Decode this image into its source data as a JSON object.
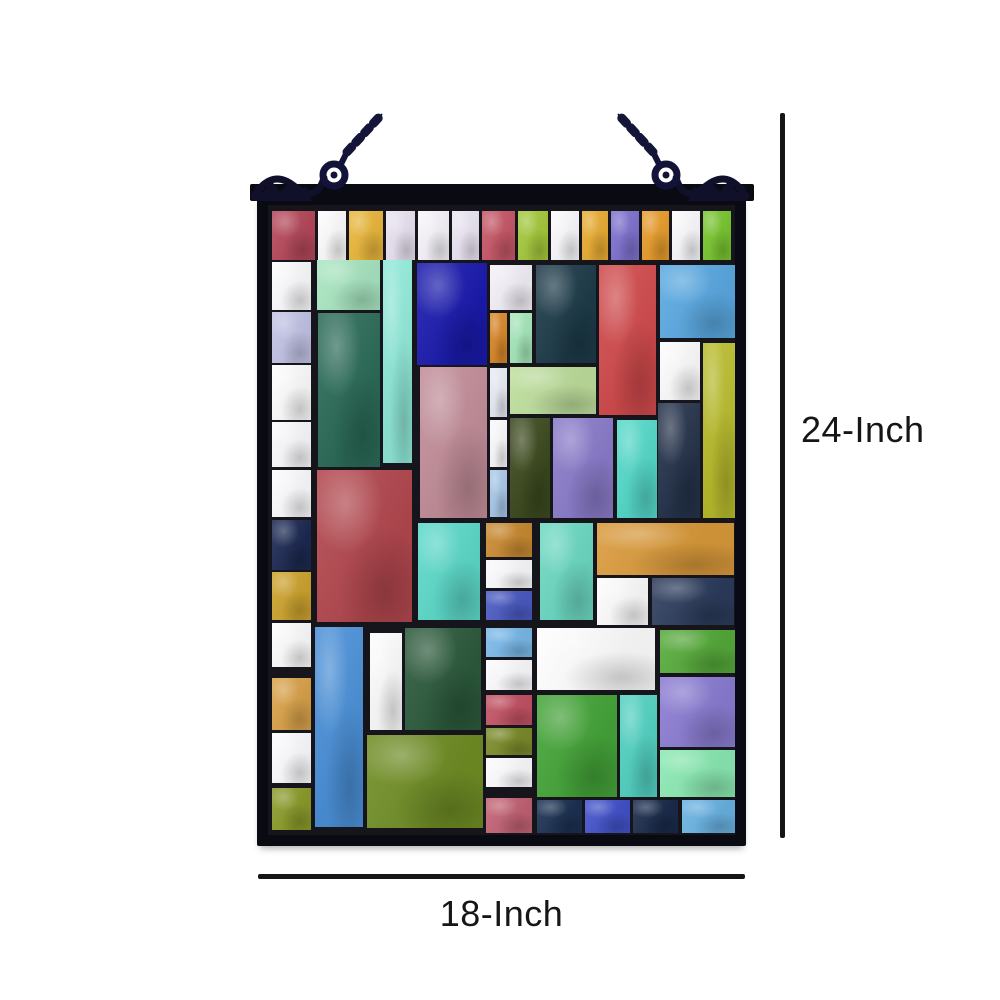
{
  "figure": {
    "subject": "Multicolor rectangle-mosaic stained glass hanging window panel with dimension callouts",
    "height_label": "24-Inch",
    "width_label": "18-Inch"
  },
  "colors": {
    "background": "#ffffff",
    "frame": "#0a0a12",
    "grout": "#15151b",
    "hardware": "#13133a",
    "dimension_line": "#151515",
    "label_text": "#161616"
  },
  "panel": {
    "glass_width": 467,
    "glass_height": 630,
    "tiles": [
      [
        4,
        6,
        43,
        49,
        "#b5485a"
      ],
      [
        50,
        6,
        28,
        49,
        "#fdfdfe"
      ],
      [
        81,
        6,
        34,
        49,
        "#eab73c"
      ],
      [
        118,
        6,
        29,
        49,
        "#e9e2f2"
      ],
      [
        150,
        6,
        31,
        49,
        "#f7f5fb"
      ],
      [
        184,
        6,
        27,
        49,
        "#ece6f4"
      ],
      [
        214,
        6,
        33,
        49,
        "#c75767"
      ],
      [
        250,
        6,
        30,
        49,
        "#a5c93c"
      ],
      [
        283,
        6,
        28,
        49,
        "#fbfafd"
      ],
      [
        314,
        6,
        26,
        49,
        "#e9ad33"
      ],
      [
        343,
        6,
        28,
        49,
        "#7e72cf"
      ],
      [
        374,
        6,
        27,
        49,
        "#e89d2c"
      ],
      [
        404,
        6,
        28,
        49,
        "#fbfbfd"
      ],
      [
        435,
        6,
        28,
        49,
        "#79c630"
      ],
      [
        4,
        57,
        39,
        48,
        "#fcfcfe"
      ],
      [
        4,
        107,
        39,
        51,
        "#c2c3e6"
      ],
      [
        4,
        160,
        39,
        55,
        "#fdfdfe"
      ],
      [
        4,
        217,
        39,
        45,
        "#fafafc"
      ],
      [
        4,
        265,
        39,
        47,
        "#fcfcfe"
      ],
      [
        4,
        315,
        39,
        50,
        "#1c2952"
      ],
      [
        4,
        367,
        39,
        48,
        "#cda32e"
      ],
      [
        4,
        418,
        39,
        44,
        "#fdfdfe"
      ],
      [
        4,
        473,
        39,
        52,
        "#d9a24a"
      ],
      [
        4,
        528,
        39,
        50,
        "#fcfcfe"
      ],
      [
        4,
        583,
        39,
        42,
        "#8b9b2a"
      ],
      [
        49,
        55,
        63,
        50,
        "#a9e6c1"
      ],
      [
        50,
        108,
        62,
        154,
        "#2b6b57"
      ],
      [
        115,
        55,
        29,
        203,
        "#8fe9d8"
      ],
      [
        49,
        265,
        95,
        152,
        "#b2474e"
      ],
      [
        47,
        422,
        48,
        200,
        "#4a90d8"
      ],
      [
        102,
        428,
        32,
        97,
        "#fdfdfe"
      ],
      [
        137,
        423,
        76,
        102,
        "#2c5a3c"
      ],
      [
        99,
        530,
        116,
        93,
        "#6f8d24"
      ],
      [
        149,
        58,
        70,
        102,
        "#1a1aae"
      ],
      [
        222,
        60,
        42,
        45,
        "#f3f0f8"
      ],
      [
        222,
        108,
        17,
        50,
        "#d8882a"
      ],
      [
        242,
        108,
        22,
        50,
        "#a5e7ba"
      ],
      [
        268,
        60,
        60,
        98,
        "#1d3b49"
      ],
      [
        331,
        60,
        57,
        150,
        "#d14a4c"
      ],
      [
        392,
        60,
        75,
        73,
        "#5aa9e2"
      ],
      [
        392,
        137,
        40,
        58,
        "#fdfdfe"
      ],
      [
        435,
        138,
        32,
        175,
        "#b8bc2c"
      ],
      [
        390,
        198,
        42,
        115,
        "#25334b"
      ],
      [
        152,
        162,
        67,
        151,
        "#c28d99"
      ],
      [
        222,
        163,
        17,
        49,
        "#e8ecf4"
      ],
      [
        222,
        215,
        17,
        47,
        "#fbfbfd"
      ],
      [
        222,
        265,
        17,
        47,
        "#a9c9e9"
      ],
      [
        242,
        162,
        86,
        47,
        "#bede9c"
      ],
      [
        242,
        213,
        40,
        100,
        "#3c4a1e"
      ],
      [
        285,
        213,
        60,
        100,
        "#8a7bca"
      ],
      [
        349,
        215,
        40,
        98,
        "#54d9c9"
      ],
      [
        150,
        318,
        62,
        97,
        "#5cd9c9"
      ],
      [
        218,
        318,
        46,
        34,
        "#c98a32"
      ],
      [
        218,
        355,
        46,
        28,
        "#fbfbfd"
      ],
      [
        218,
        386,
        46,
        29,
        "#4a5ac2"
      ],
      [
        272,
        318,
        53,
        97,
        "#6cd9c2"
      ],
      [
        329,
        318,
        137,
        52,
        "#d9993a"
      ],
      [
        329,
        373,
        51,
        47,
        "#fdfdfe"
      ],
      [
        384,
        373,
        82,
        47,
        "#2c3c5c"
      ],
      [
        218,
        423,
        46,
        29,
        "#7ab9e9"
      ],
      [
        218,
        455,
        46,
        30,
        "#fcfcfe"
      ],
      [
        218,
        490,
        46,
        30,
        "#c25264"
      ],
      [
        218,
        523,
        46,
        27,
        "#7b8b2a"
      ],
      [
        218,
        553,
        46,
        29,
        "#fcfcfe"
      ],
      [
        218,
        593,
        46,
        35,
        "#c26274"
      ],
      [
        269,
        423,
        118,
        62,
        "#fefefe"
      ],
      [
        392,
        425,
        75,
        43,
        "#56aa3a"
      ],
      [
        392,
        472,
        75,
        70,
        "#8b7cd2"
      ],
      [
        392,
        545,
        75,
        47,
        "#8ae9b2"
      ],
      [
        414,
        595,
        53,
        33,
        "#69b2e2"
      ],
      [
        269,
        490,
        80,
        102,
        "#44a438"
      ],
      [
        352,
        490,
        37,
        102,
        "#52d2c2"
      ],
      [
        269,
        595,
        45,
        33,
        "#1b3152"
      ],
      [
        317,
        595,
        45,
        33,
        "#4252ca"
      ],
      [
        365,
        595,
        45,
        33,
        "#192a4a"
      ]
    ]
  }
}
